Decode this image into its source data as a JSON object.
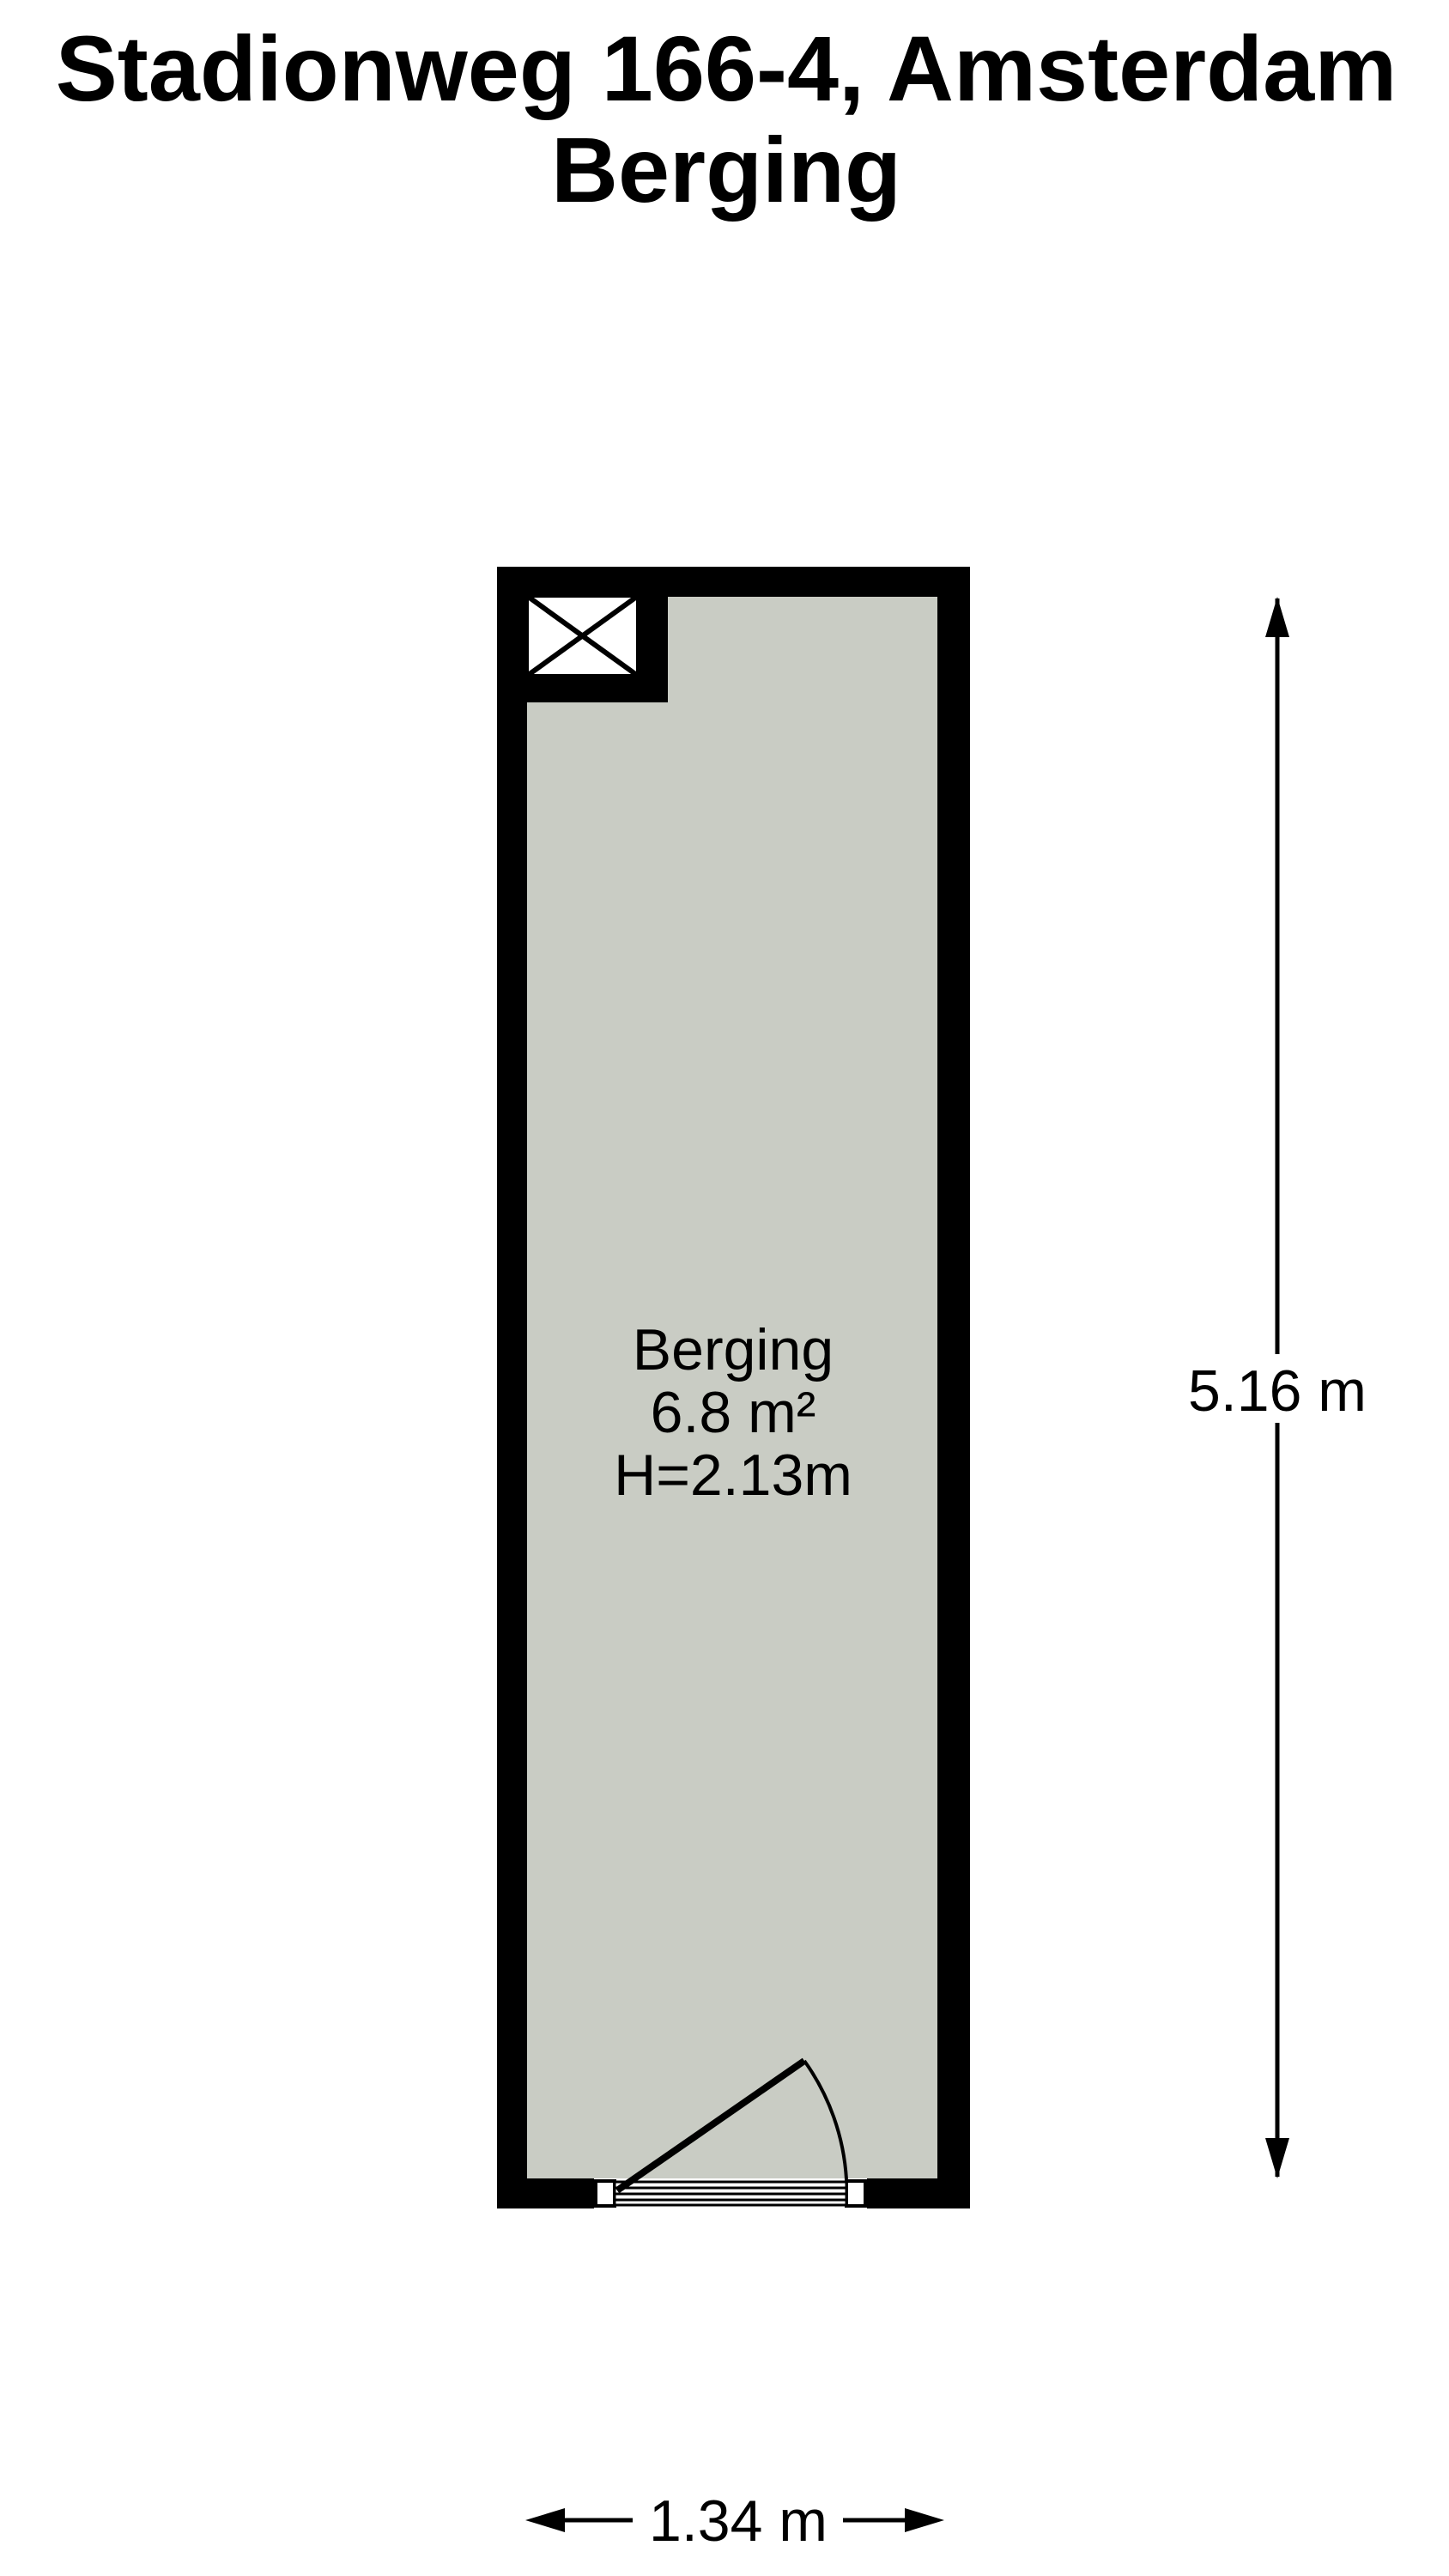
{
  "title": {
    "line1": "Stadionweg 166-4, Amsterdam",
    "line2": "Berging"
  },
  "room": {
    "name": "Berging",
    "area": "6.8 m²",
    "ceiling_height": "H=2.13m"
  },
  "dimensions": {
    "vertical_label": "5.16 m",
    "horizontal_label": "1.34 m"
  },
  "icons": {
    "shaft_symbol": "crossed-square-shaft",
    "door_symbol": "door-swing-arc",
    "arrows": [
      "arrow-up",
      "arrow-down",
      "arrow-left",
      "arrow-right"
    ]
  },
  "colors": {
    "wall": "#000000",
    "floor": "#c9ccc4",
    "background": "#ffffff",
    "text": "#000000"
  }
}
